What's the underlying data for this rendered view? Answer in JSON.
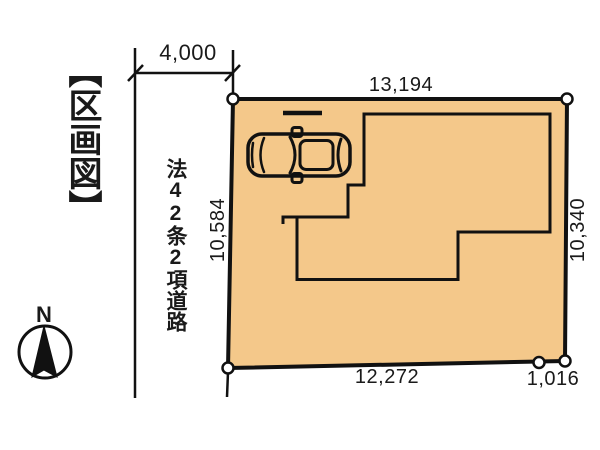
{
  "title": "【区画図】",
  "compass": {
    "north_label": "N",
    "icon": "north-compass-icon"
  },
  "road": {
    "label": "法42条2項道路",
    "width_dimension": "4,000"
  },
  "plot": {
    "fill_color": "#F4C88A",
    "line_color": "#111111",
    "dimensions": {
      "top": "13,194",
      "left": "10,584",
      "right": "10,340",
      "bottom": "12,272",
      "bottom_right": "1,016"
    }
  },
  "icons": {
    "car": "car-top-view-icon",
    "compass": "north-compass-icon"
  }
}
